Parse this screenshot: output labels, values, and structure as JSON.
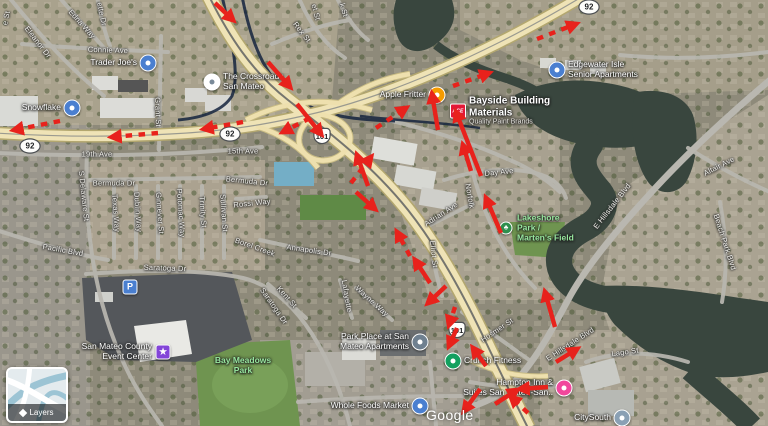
{
  "map": {
    "attribution": "Google",
    "layers_label": "Layers"
  },
  "colors": {
    "arrow_red": "#e8221c",
    "water": "#39463e",
    "highway_yellow": "#efe3b6",
    "road_gray": "#b9b7b0",
    "park_green": "#6f9450",
    "park_label_green": "#98e89f",
    "pin_blue": "#4a7fd0",
    "pin_orange": "#f59b00",
    "pin_green": "#13a05f",
    "pin_pink": "#f1479c",
    "pin_purple": "#8345d8",
    "pin_gray": "#6f8090",
    "ace_red": "#e31837"
  },
  "shields": [
    {
      "t": "92",
      "kind": "oval",
      "x": 30,
      "y": 146
    },
    {
      "t": "92",
      "kind": "oval",
      "x": 230,
      "y": 134
    },
    {
      "t": "92",
      "kind": "oval",
      "x": 589,
      "y": 7
    },
    {
      "t": "101",
      "kind": "us",
      "x": 322,
      "y": 136
    },
    {
      "t": "101",
      "kind": "us",
      "x": 457,
      "y": 330
    }
  ],
  "streets": [
    {
      "t": "e St",
      "x": 6,
      "y": 18,
      "r": -78
    },
    {
      "t": "Eleanor Dr",
      "x": 38,
      "y": 42,
      "r": 52
    },
    {
      "t": "Edna Way",
      "x": 82,
      "y": 24,
      "r": 48
    },
    {
      "t": "ette Dr",
      "x": 102,
      "y": 14,
      "r": 78
    },
    {
      "t": "et St",
      "x": 316,
      "y": 12,
      "r": 75
    },
    {
      "t": "k St",
      "x": 344,
      "y": 10,
      "r": 75
    },
    {
      "t": "Rex St",
      "x": 302,
      "y": 32,
      "r": 52
    },
    {
      "t": "Connie Ave",
      "x": 108,
      "y": 50,
      "r": 2
    },
    {
      "t": "Grant St",
      "x": 158,
      "y": 112,
      "r": 88
    },
    {
      "t": "19th Ave",
      "x": 97,
      "y": 154,
      "r": 0
    },
    {
      "t": "15th Ave",
      "x": 243,
      "y": 151,
      "r": 0
    },
    {
      "t": "Bermuda Dr",
      "x": 114,
      "y": 183,
      "r": 0
    },
    {
      "t": "Bermuda Dr",
      "x": 247,
      "y": 181,
      "r": 6
    },
    {
      "t": "Rossi Way",
      "x": 252,
      "y": 203,
      "r": -6
    },
    {
      "t": "S Delaware St",
      "x": 84,
      "y": 196,
      "r": 84
    },
    {
      "t": "Texas Way",
      "x": 116,
      "y": 213,
      "r": 86
    },
    {
      "t": "Dublin Way",
      "x": 138,
      "y": 212,
      "r": 86
    },
    {
      "t": "Ginnever St",
      "x": 160,
      "y": 213,
      "r": 86
    },
    {
      "t": "Potomac Way",
      "x": 181,
      "y": 213,
      "r": 86
    },
    {
      "t": "Trinity St",
      "x": 203,
      "y": 212,
      "r": 86
    },
    {
      "t": "Sullivan St",
      "x": 224,
      "y": 213,
      "r": 86
    },
    {
      "t": "Pacific Blvd",
      "x": 63,
      "y": 250,
      "r": 10
    },
    {
      "t": "Saratoga Dr",
      "x": 165,
      "y": 268,
      "r": 2
    },
    {
      "t": "Saratoga Dr",
      "x": 274,
      "y": 306,
      "r": 55
    },
    {
      "t": "Borel Creek",
      "x": 255,
      "y": 247,
      "r": 20
    },
    {
      "t": "Annapolis Dr",
      "x": 309,
      "y": 250,
      "r": 8
    },
    {
      "t": "Kent St",
      "x": 287,
      "y": 297,
      "r": 48
    },
    {
      "t": "Lafayette",
      "x": 347,
      "y": 296,
      "r": 80
    },
    {
      "t": "Wayne Way",
      "x": 372,
      "y": 301,
      "r": 42
    },
    {
      "t": "Day Ave",
      "x": 499,
      "y": 172,
      "r": -6
    },
    {
      "t": "Norfolk",
      "x": 470,
      "y": 196,
      "r": 80
    },
    {
      "t": "Adrian Ave",
      "x": 441,
      "y": 214,
      "r": -33
    },
    {
      "t": "Elliot St",
      "x": 434,
      "y": 254,
      "r": 84
    },
    {
      "t": "Hosmer St",
      "x": 497,
      "y": 330,
      "r": -34
    },
    {
      "t": "E Hillsdale Blvd",
      "x": 612,
      "y": 206,
      "r": -52
    },
    {
      "t": "E Hillsdale Blvd",
      "x": 570,
      "y": 344,
      "r": -33
    },
    {
      "t": "Altair Ave",
      "x": 719,
      "y": 166,
      "r": -27
    },
    {
      "t": "Beach Park Blvd",
      "x": 725,
      "y": 242,
      "r": 72
    },
    {
      "t": "Lago St",
      "x": 625,
      "y": 352,
      "r": -8
    }
  ],
  "pois": [
    {
      "id": "trader-joes",
      "lines": [
        "Trader Joe's"
      ],
      "x": 148,
      "y": 63,
      "side": "left",
      "pin": "circle",
      "icon": "grocery-pin-icon",
      "color": "#4a7fd0"
    },
    {
      "id": "snowflake",
      "lines": [
        "Snowflake"
      ],
      "x": 72,
      "y": 108,
      "side": "left",
      "pin": "circle",
      "icon": "place-pin-icon",
      "color": "#4a7fd0"
    },
    {
      "id": "the-crossroads-san-mateo",
      "lines": [
        "The Crossroads",
        "San Mateo"
      ],
      "x": 212,
      "y": 82,
      "side": "right",
      "pin": "circle",
      "icon": "place-pin-icon",
      "color": "#ffffff",
      "dot": "#7a8a99"
    },
    {
      "id": "apple-fritter",
      "lines": [
        "Apple Fritter"
      ],
      "x": 437,
      "y": 95,
      "side": "left",
      "pin": "circle",
      "icon": "restaurant-pin-icon",
      "color": "#f59b00"
    },
    {
      "id": "bayside-building-materials",
      "lines": [
        "Bayside Building",
        "Materials"
      ],
      "sub": "Quality Paint Brands",
      "x": 458,
      "y": 111,
      "side": "right",
      "pin": "ace",
      "icon": "ace-logo-icon",
      "color": "#e31837",
      "glyph": "ACE",
      "style": "big"
    },
    {
      "id": "edgewater-isle",
      "lines": [
        "Edgewater Isle",
        "Senior Apartments"
      ],
      "x": 557,
      "y": 70,
      "side": "right",
      "pin": "circle",
      "icon": "apartment-pin-icon",
      "color": "#4a7fd0"
    },
    {
      "id": "lakeshore-park",
      "lines": [
        "Lakeshore",
        "Park /",
        "Marten's Field"
      ],
      "x": 506,
      "y": 228,
      "side": "right",
      "pin": "park",
      "icon": "park-icon",
      "color": "#2f8f4e",
      "glyph": "♣",
      "style": "green"
    },
    {
      "id": "san-mateo-county-event-center",
      "lines": [
        "San Mateo County",
        "Event Center"
      ],
      "x": 163,
      "y": 352,
      "side": "left",
      "pin": "square",
      "icon": "event-pin-icon",
      "color": "#8345d8",
      "glyph": "★"
    },
    {
      "id": "parking",
      "lines": [],
      "x": 130,
      "y": 287,
      "side": "none",
      "pin": "square",
      "icon": "parking-icon",
      "color": "#4a7fd0",
      "glyph": "P"
    },
    {
      "id": "bay-meadows-park",
      "lines": [
        "Bay Meadows",
        "Park"
      ],
      "x": 243,
      "y": 366,
      "side": "center",
      "pin": "none",
      "icon": "park-icon",
      "style": "green"
    },
    {
      "id": "park-place-apartments",
      "lines": [
        "Park Place at San",
        "Mateo Apartments"
      ],
      "x": 420,
      "y": 342,
      "side": "left",
      "pin": "circle",
      "icon": "apartment-pin-icon",
      "color": "#6f8090"
    },
    {
      "id": "crunch-fitness",
      "lines": [
        "Crunch Fitness"
      ],
      "x": 453,
      "y": 361,
      "side": "right",
      "pin": "circle",
      "icon": "fitness-pin-icon",
      "color": "#13a05f"
    },
    {
      "id": "whole-foods-market",
      "lines": [
        "Whole Foods Market"
      ],
      "x": 420,
      "y": 406,
      "side": "left",
      "pin": "circle",
      "icon": "grocery-pin-icon",
      "color": "#4a7fd0"
    },
    {
      "id": "hampton-inn",
      "lines": [
        "Hampton Inn &",
        "Suites San Mateo-San.."
      ],
      "x": 564,
      "y": 388,
      "side": "left",
      "pin": "circle",
      "icon": "hotel-pin-icon",
      "color": "#f1479c"
    },
    {
      "id": "citysouth",
      "lines": [
        "CitySouth"
      ],
      "x": 622,
      "y": 418,
      "side": "left",
      "pin": "circle",
      "icon": "place-pin-icon",
      "color": "#8aa0b4"
    }
  ],
  "arrows": [
    {
      "x1": 215,
      "y1": 3,
      "x2": 233,
      "y2": 20,
      "d": 0
    },
    {
      "x1": 243,
      "y1": 122,
      "x2": 204,
      "y2": 129,
      "d": 1
    },
    {
      "x1": 158,
      "y1": 133,
      "x2": 112,
      "y2": 137,
      "d": 1
    },
    {
      "x1": 60,
      "y1": 121,
      "x2": 14,
      "y2": 130,
      "d": 1
    },
    {
      "x1": 268,
      "y1": 62,
      "x2": 290,
      "y2": 87,
      "d": 0
    },
    {
      "x1": 310,
      "y1": 118,
      "x2": 283,
      "y2": 132,
      "d": 1
    },
    {
      "x1": 297,
      "y1": 104,
      "x2": 321,
      "y2": 134,
      "d": 0
    },
    {
      "x1": 376,
      "y1": 128,
      "x2": 406,
      "y2": 108,
      "d": 1
    },
    {
      "x1": 438,
      "y1": 130,
      "x2": 432,
      "y2": 94,
      "d": 0
    },
    {
      "x1": 481,
      "y1": 176,
      "x2": 456,
      "y2": 112,
      "d": 0
    },
    {
      "x1": 453,
      "y1": 86,
      "x2": 489,
      "y2": 73,
      "d": 1
    },
    {
      "x1": 537,
      "y1": 39,
      "x2": 576,
      "y2": 24,
      "d": 1
    },
    {
      "x1": 471,
      "y1": 171,
      "x2": 463,
      "y2": 145,
      "d": 0
    },
    {
      "x1": 501,
      "y1": 233,
      "x2": 486,
      "y2": 198,
      "d": 0
    },
    {
      "x1": 555,
      "y1": 327,
      "x2": 545,
      "y2": 292,
      "d": 0
    },
    {
      "x1": 556,
      "y1": 362,
      "x2": 577,
      "y2": 349,
      "d": 0
    },
    {
      "x1": 368,
      "y1": 186,
      "x2": 357,
      "y2": 155,
      "d": 0
    },
    {
      "x1": 351,
      "y1": 183,
      "x2": 371,
      "y2": 157,
      "d": 1
    },
    {
      "x1": 356,
      "y1": 192,
      "x2": 375,
      "y2": 209,
      "d": 0
    },
    {
      "x1": 410,
      "y1": 256,
      "x2": 397,
      "y2": 232,
      "d": 1
    },
    {
      "x1": 430,
      "y1": 283,
      "x2": 415,
      "y2": 260,
      "d": 0
    },
    {
      "x1": 446,
      "y1": 286,
      "x2": 428,
      "y2": 303,
      "d": 0
    },
    {
      "x1": 455,
      "y1": 307,
      "x2": 449,
      "y2": 325,
      "d": 1
    },
    {
      "x1": 457,
      "y1": 328,
      "x2": 449,
      "y2": 346,
      "d": 0
    },
    {
      "x1": 486,
      "y1": 366,
      "x2": 473,
      "y2": 348,
      "d": 0
    },
    {
      "x1": 480,
      "y1": 389,
      "x2": 464,
      "y2": 411,
      "d": 0
    },
    {
      "x1": 495,
      "y1": 404,
      "x2": 517,
      "y2": 390,
      "d": 0
    },
    {
      "x1": 548,
      "y1": 387,
      "x2": 520,
      "y2": 389,
      "d": 0
    },
    {
      "x1": 528,
      "y1": 413,
      "x2": 511,
      "y2": 397,
      "d": 1
    }
  ]
}
